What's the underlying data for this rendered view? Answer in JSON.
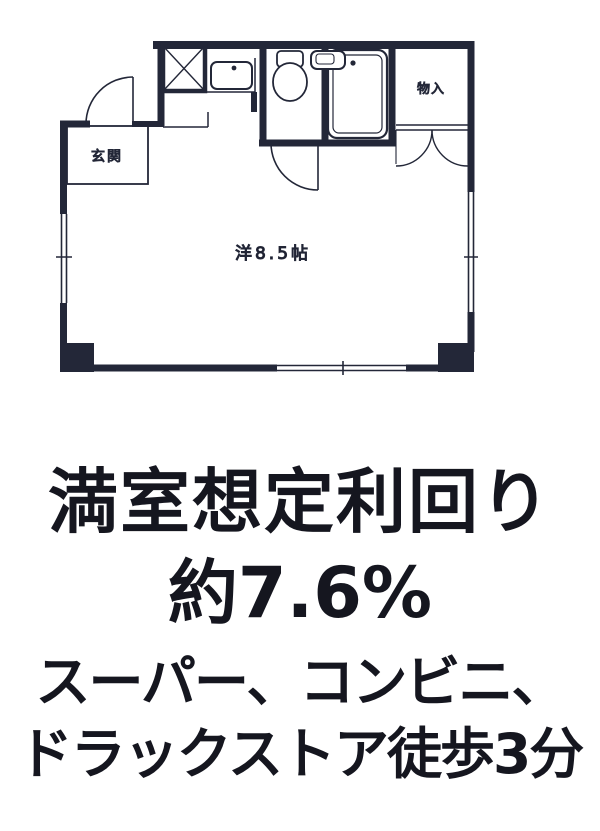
{
  "floor_plan": {
    "room_label": "洋8.5帖",
    "entrance_label": "玄関",
    "closet_label": "物入"
  },
  "caption": {
    "yield_title": "満室想定利回り",
    "yield_value": "約7.6%",
    "access_line1": "スーパー、コンビニ、",
    "access_line2": "ドラックストア徒歩3分"
  },
  "colors": {
    "ink": "#15161f",
    "wall": "#232738",
    "background": "#ffffff"
  }
}
